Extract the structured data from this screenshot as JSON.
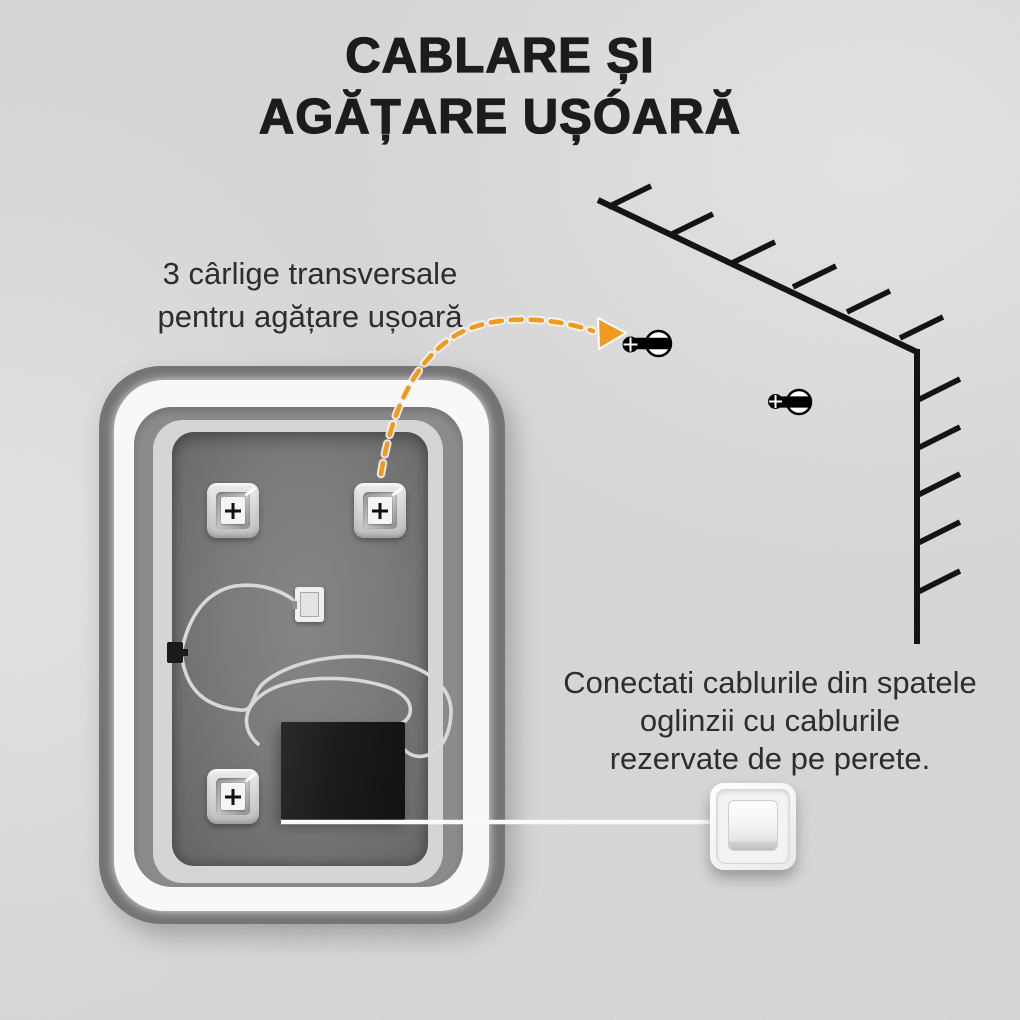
{
  "title": {
    "line1": "CABLARE ȘI",
    "line2": "AGĂȚARE UȘÓARĂ"
  },
  "notes": {
    "hooks": {
      "line1": "3 cârlige transversale",
      "line2": "pentru agățare ușoară"
    },
    "cables": {
      "line1": "Conectati cablurile din spatele",
      "line2": "oglinzii cu cablurile",
      "line3": "rezervate de pe perete."
    }
  },
  "colors": {
    "wall": "#D9D9D9",
    "title_text": "#1C1C1C",
    "body_text": "#2D2D2D",
    "accent_orange": "#F09A1F",
    "diagram_line": "#141414",
    "cable": "#D8D8D8",
    "mirror_frame": "#747474",
    "led_ring": "#F8F8F8",
    "mirror_panel": "#7A7A7A",
    "inner_border": "#D5D5D5",
    "junction_box": "#1B1B1B",
    "switch_plate": "#F6F6F6"
  },
  "icons": {
    "mounting_hook": "plus-square-keycap",
    "screw_anchor": "screw-with-wall-plug",
    "light_switch": "rocker-switch",
    "dashed_arrow": "curved-dashed-arrow",
    "wall_corner": "hatched-corner-lines",
    "cable_connector": "white-plug-box",
    "junction_box": "black-driver-box"
  },
  "diagram": {
    "hook_count": 3,
    "screw_count": 2
  }
}
